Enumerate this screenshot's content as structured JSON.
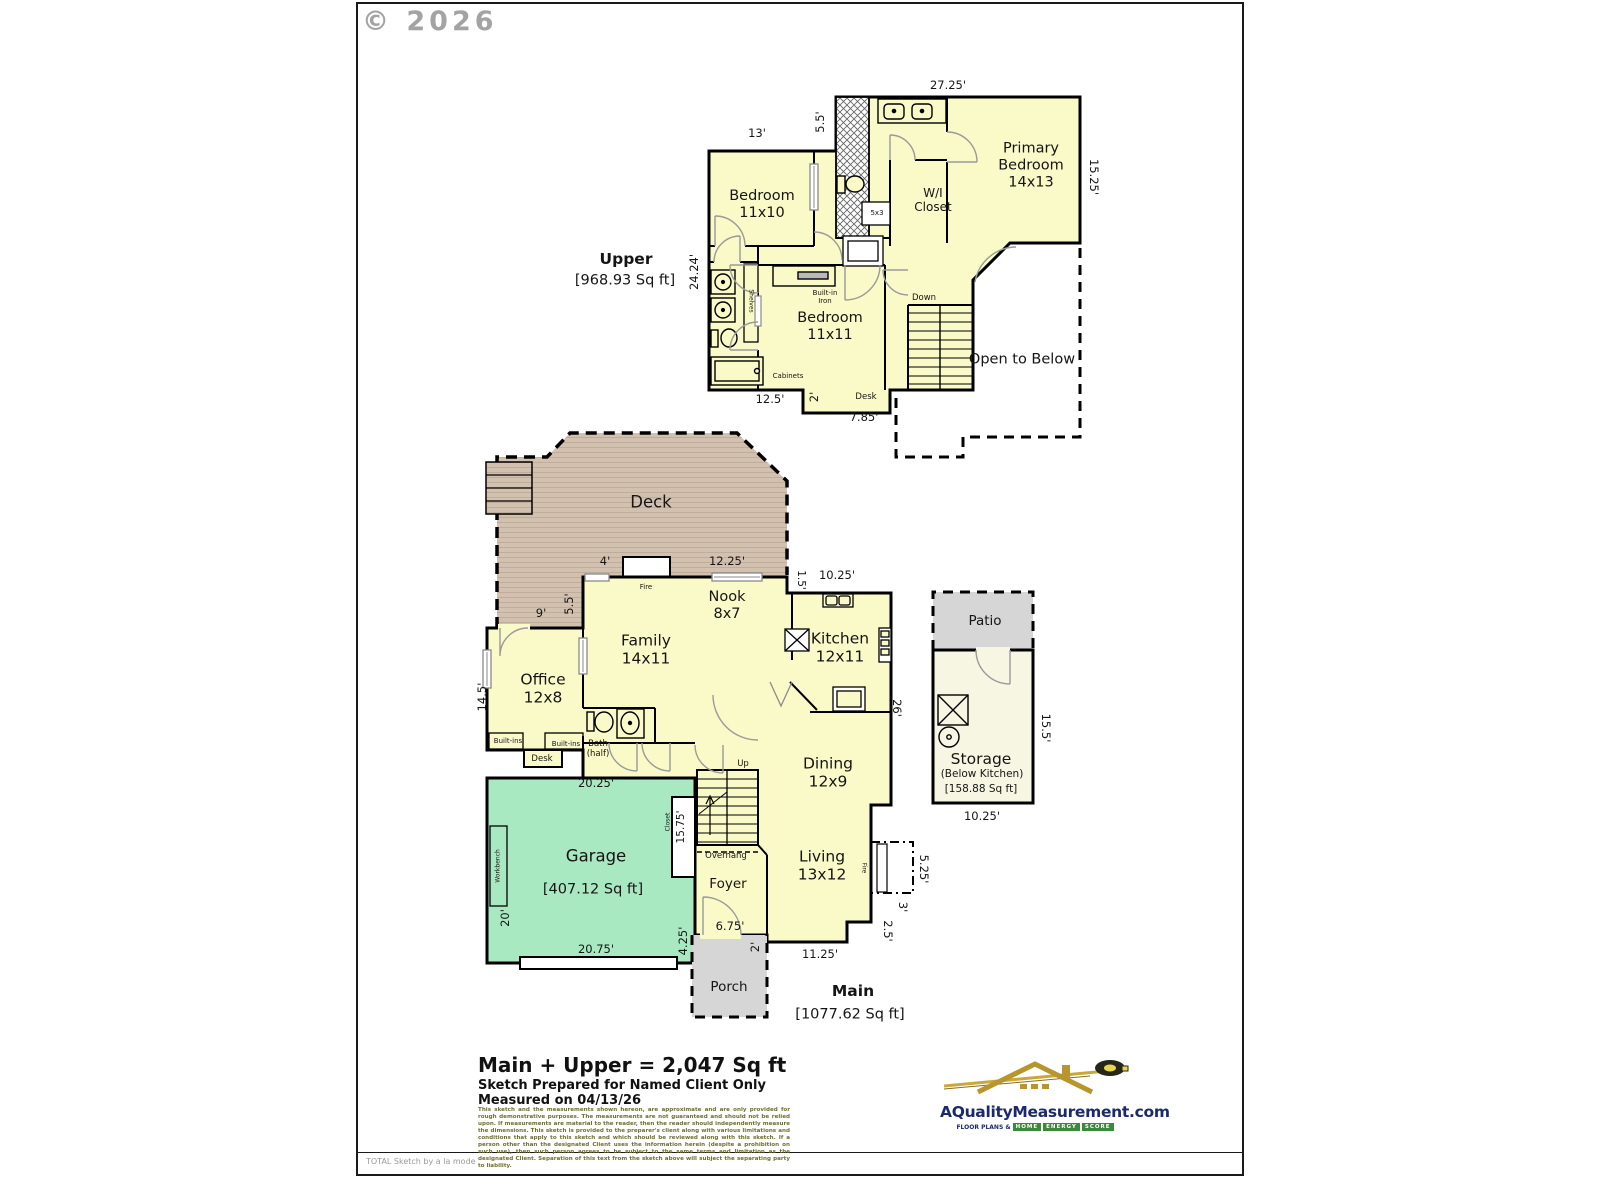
{
  "watermark": "© 2026",
  "footer": "TOTAL Sketch by a la mode",
  "upper": {
    "title": "Upper",
    "sqft": "[968.93 Sq ft]",
    "rooms": {
      "bedroom1": "Bedroom\n11x10",
      "primary": "Primary\nBedroom\n14x13",
      "wi_closet": "W/I\nCloset",
      "bedroom2": "Bedroom\n11x11",
      "open_below": "Open to Below"
    },
    "features": {
      "down": "Down",
      "shower": "5x3",
      "iron": "Built-in\nIron",
      "shelves": "Shelves",
      "cabinets": "Cabinets",
      "desk": "Desk"
    },
    "dims": {
      "top": "27.25'",
      "bed1_top": "13'",
      "bath_jog": "5.5'",
      "right": "15.25'",
      "left": "24.24'",
      "bottom_left": "12.5'",
      "desk_jog": "2'",
      "desk_bottom": "7.85'"
    }
  },
  "main": {
    "title": "Main",
    "sqft": "[1077.62 Sq ft]",
    "rooms": {
      "deck": "Deck",
      "nook": "Nook\n8x7",
      "family": "Family\n14x11",
      "kitchen": "Kitchen\n12x11",
      "office": "Office\n12x8",
      "dining": "Dining\n12x9",
      "living": "Living\n13x12",
      "foyer": "Foyer",
      "garage": "Garage",
      "garage_sqft": "[407.12 Sq ft]",
      "porch": "Porch"
    },
    "features": {
      "fire_deck": "Fire",
      "fire_living": "Fire",
      "bath_half": "Bath\n(half)",
      "built_ins_a": "Built-ins",
      "built_ins_b": "Built-ins",
      "desk": "Desk",
      "up": "Up",
      "overhang": "Overhang",
      "workbench": "Workbench",
      "closet": "Closet"
    },
    "dims": {
      "deck_door": "4'",
      "deck_right": "12.25'",
      "kitchen_top": "10.25'",
      "kitchen_jog": "1.5'",
      "deck_left_w": "9'",
      "deck_left_h": "5.5'",
      "office_left": "14.5'",
      "right": "26'",
      "garage_top": "20.25'",
      "closet_h": "15.75'",
      "garage_left": "20'",
      "garage_bottom": "20.75'",
      "porch_jog": "4.25'",
      "porch_top": "6.75'",
      "porch_side": "2'",
      "living_bottom": "11.25'",
      "fire_h": "5.25'",
      "fire_side": "3'",
      "living_jog": "2.5'"
    }
  },
  "annex": {
    "patio": "Patio",
    "storage": "Storage",
    "storage_sub": "(Below Kitchen)",
    "storage_sqft": "[158.88 Sq ft]",
    "dims": {
      "right": "15.5'",
      "bottom": "10.25'"
    }
  },
  "summary": {
    "total": "Main + Upper = 2,047 Sq ft",
    "prepared": "Sketch Prepared for Named Client Only",
    "measured": "Measured on 04/13/26",
    "disclaimer": "This sketch and the measurements shown hereon, are approximate and are only provided for rough demonstrative purposes. The measurements are not guaranteed and should not be relied upon.  If measurements are material to the reader, then the reader should independently measure the dimensions.  This sketch is provided to the preparer's client along with various limitations and conditions that apply to this sketch and which should be reviewed along with this sketch.  If a person other than the designated Client uses the information herein (despite a prohibition on such use), then such person agrees to be subject to the same terms and limitation as the designated Client.  Separation of this text from the sketch above will subject the separating party to liability."
  },
  "branding": {
    "site": "AQualityMeasurement.com",
    "tagline_prefix": "FLOOR PLANS &",
    "tagline_words": [
      "HOME",
      "ENERGY",
      "SCORE"
    ]
  },
  "colors": {
    "room_yellow": "#FAFAC8",
    "deck_tan": "#D3C1B0",
    "garage_green": "#A9E9C1",
    "patio_gray": "#D6D6D6",
    "storage_cream": "#F6F6E3",
    "logo_navy": "#1B2A6B",
    "logo_gold": "#B8962E",
    "disclaimer_olive": "#6E6E2E",
    "watermark_gray": "#A3A3A3"
  }
}
